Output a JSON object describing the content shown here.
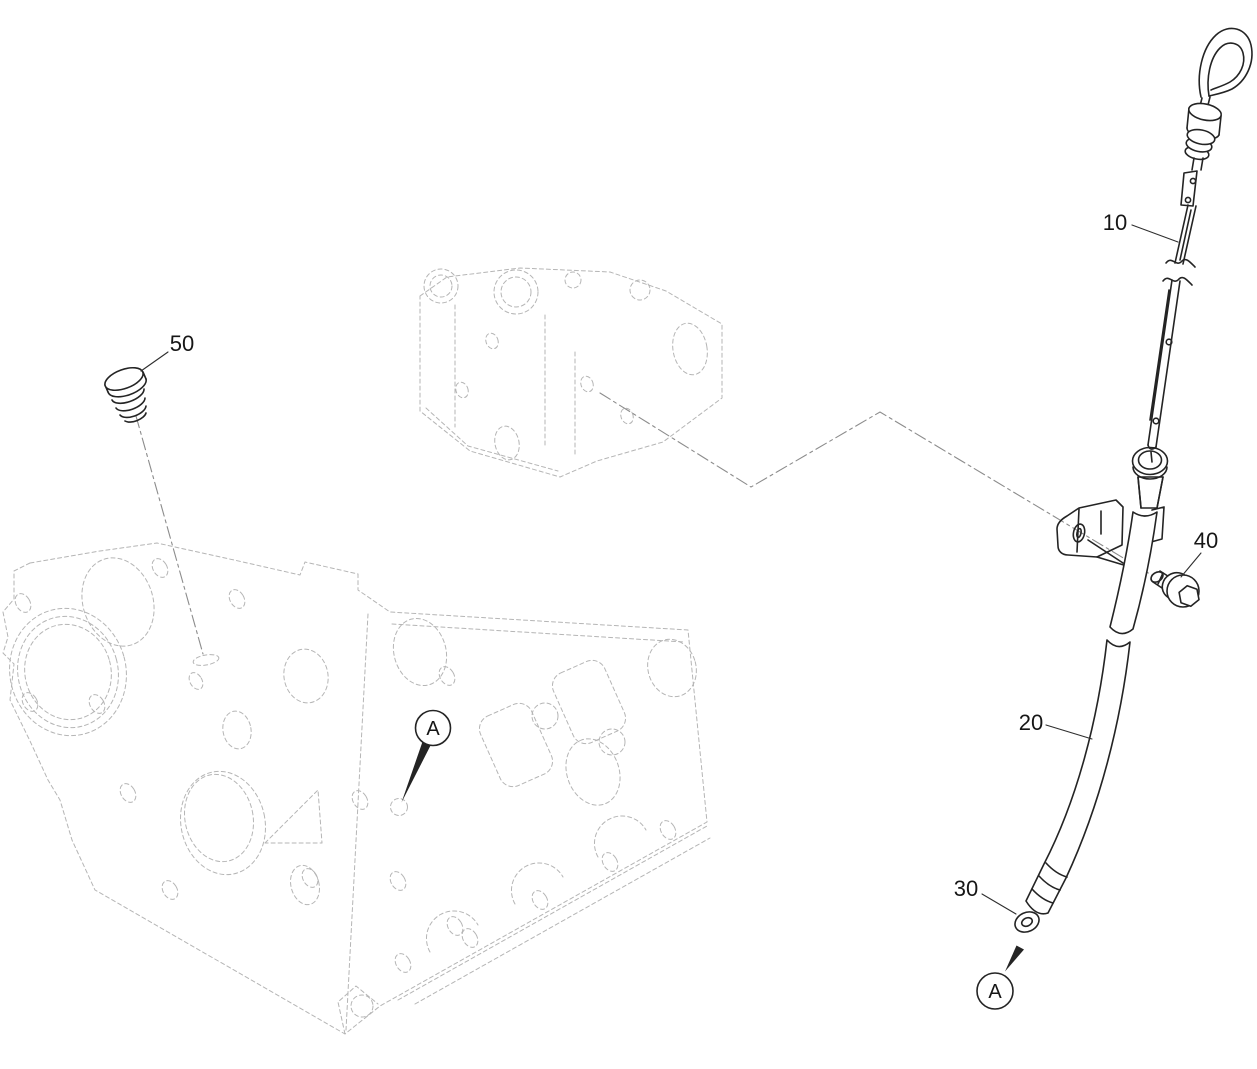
{
  "diagram": {
    "kind": "engine oil dipstick exploded parts diagram",
    "callouts": [
      {
        "id": "10",
        "text": "10"
      },
      {
        "id": "20",
        "text": "20"
      },
      {
        "id": "30",
        "text": "30"
      },
      {
        "id": "40",
        "text": "40"
      },
      {
        "id": "50",
        "text": "50"
      }
    ],
    "detail_markers": [
      {
        "id": "detail-a-block",
        "letter": "A"
      },
      {
        "id": "detail-a-tube-end",
        "letter": "A"
      }
    ],
    "colors": {
      "part_line": "#242424",
      "context_line": "#b5b5b5",
      "centerline": "#8c8c8c",
      "label_text": "#161616",
      "background": "#ffffff"
    }
  }
}
